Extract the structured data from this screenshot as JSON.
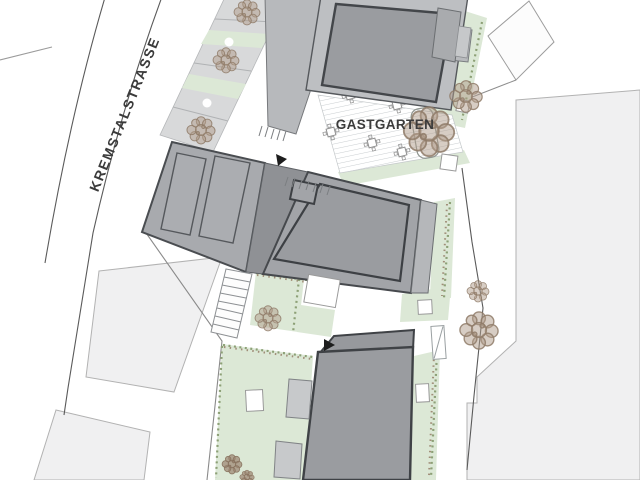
{
  "plan": {
    "labels": {
      "street": "KREMSTALSTRASSE",
      "garden": "GASTGARTEN"
    },
    "colors": {
      "parcel": "#f0f0f1",
      "parking": "#d8d9da",
      "green": "#dce8d6",
      "building_dark": "#9a9ca0",
      "building_mid": "#a8aaae",
      "building_light": "#bdbfc2",
      "outline": "#3f4246",
      "tree": "#a5907e",
      "text": "#3b3b3b"
    }
  }
}
